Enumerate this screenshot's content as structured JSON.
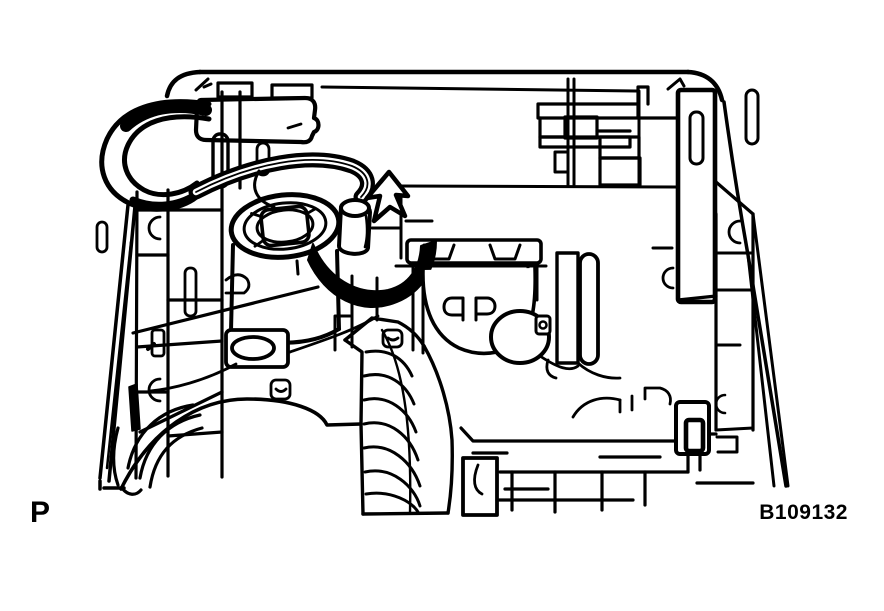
{
  "figure": {
    "type": "technical-line-illustration",
    "subject": "headlight assembly rear view with bulb socket, wiring connector and rotation arrow",
    "view_label": "P",
    "figure_code": "B109132",
    "molded_marking": "ꟼP",
    "colors": {
      "line": "#000000",
      "background": "#ffffff",
      "arrow_fill": "#000000"
    }
  }
}
